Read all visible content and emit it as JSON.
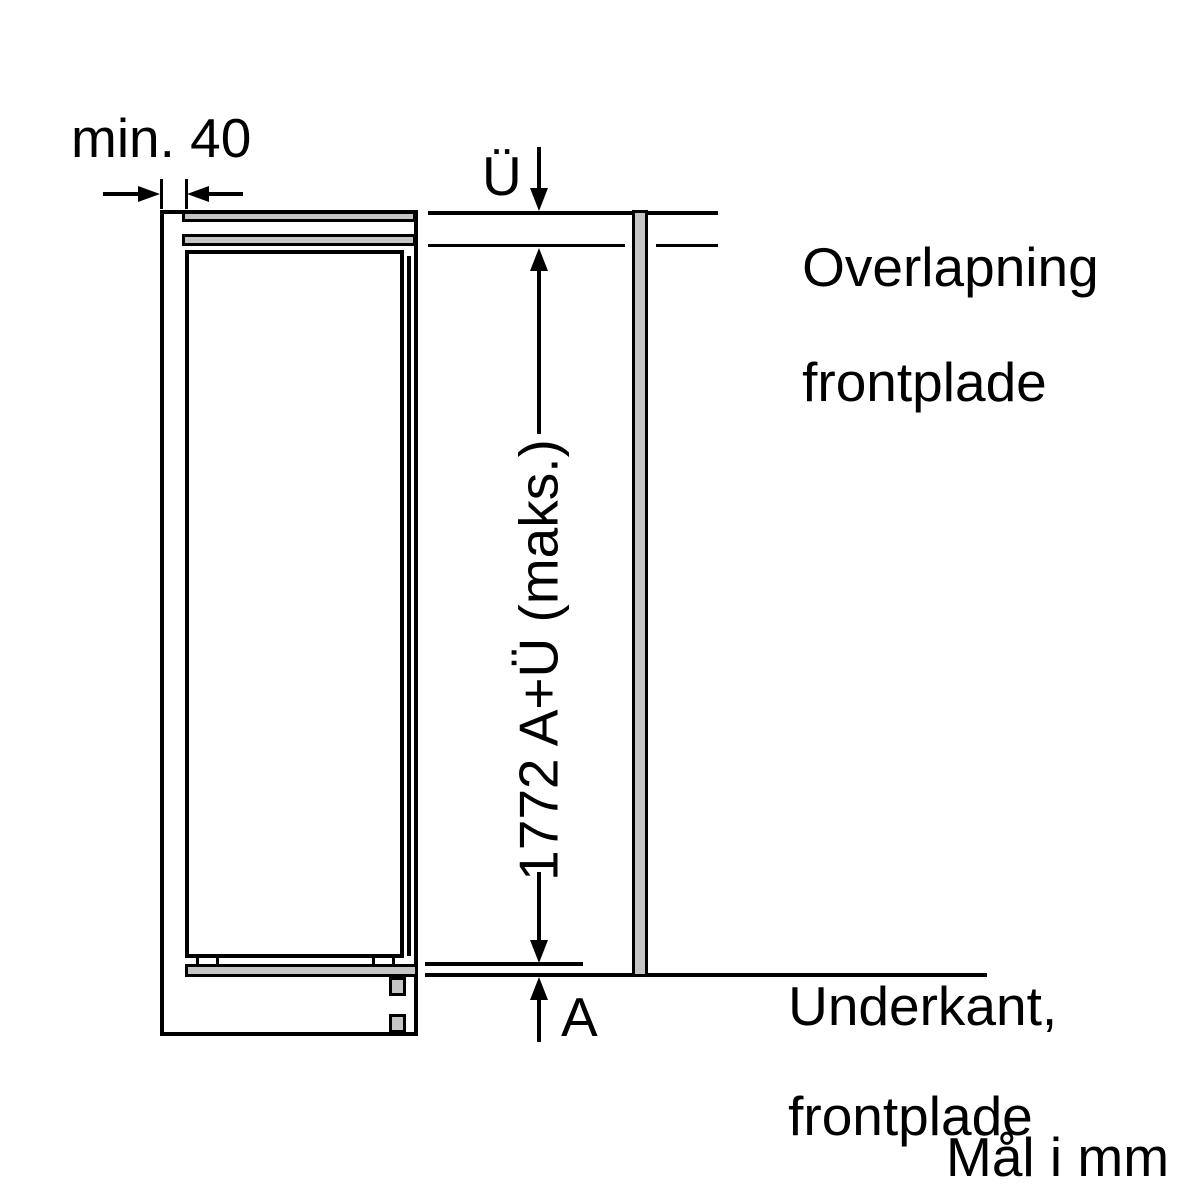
{
  "diagram": {
    "unit_note": "Mål i mm",
    "min_width_label": "min. 40",
    "overlap_symbol": "Ü",
    "overlap_note_line1": "Overlapning",
    "overlap_note_line2": "frontplade",
    "height_dimension_label": "1772 A+Ü (maks.)",
    "bottom_symbol": "A",
    "underkant_note_line1": "Underkant,",
    "underkant_note_line2": "frontplade"
  },
  "colors": {
    "line": "#000000",
    "panel_fill": "#c5c5c5",
    "background": "#ffffff"
  }
}
